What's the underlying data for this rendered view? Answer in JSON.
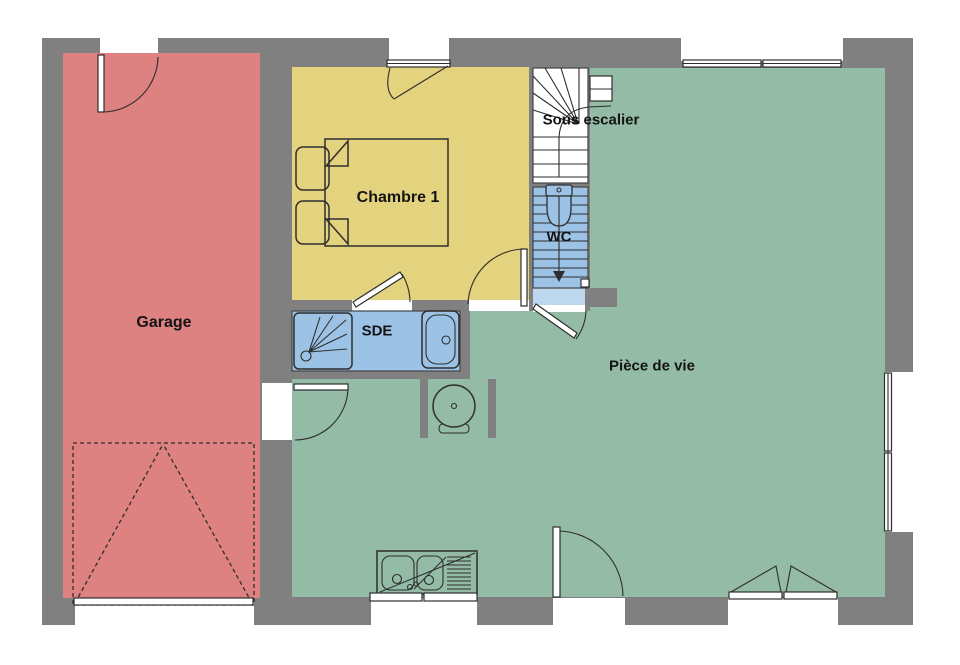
{
  "plan": {
    "rooms": {
      "garage": {
        "label": "Garage"
      },
      "bedroom": {
        "label": "Chambre 1"
      },
      "stairs": {
        "label": "Sous escalier"
      },
      "wc": {
        "label": "WC"
      },
      "shower_room": {
        "label": "SDE"
      },
      "living_room": {
        "label": "Pièce de vie"
      }
    },
    "colors": {
      "wall": "#808080",
      "garage": "#DD8181",
      "bedroom": "#E3D27E",
      "bathroom": "#9CC3E5",
      "bathroom_light": "#BDD7EE",
      "living": "#93BBA6",
      "background": "#FFFFFF",
      "line": "#2E2E2E",
      "text": "#141414"
    }
  }
}
